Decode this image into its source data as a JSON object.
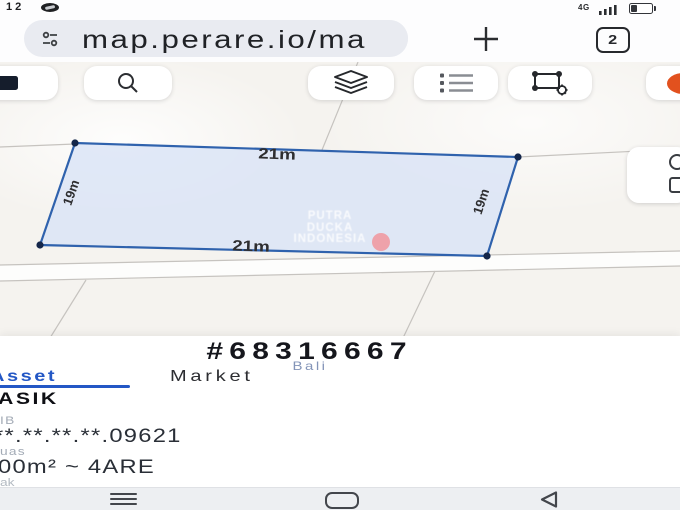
{
  "status_bar": {
    "time": "12",
    "network": "4G"
  },
  "browser": {
    "url": "map.perare.io/ma",
    "tab_count": "2"
  },
  "map": {
    "dimensions": {
      "top": "21m",
      "bottom": "21m",
      "left": "19m",
      "right": "19m"
    },
    "watermark_lines": [
      "PUTRA",
      "DUCKA",
      "INDONESIA"
    ],
    "colors": {
      "parcel_fill": "#d9e4f6",
      "parcel_border": "#2f62ad",
      "vertex": "#14264a",
      "watermark_dot": "#ef9aa2",
      "record_button": "#e2511e"
    }
  },
  "sheet": {
    "parcel_id": "#68316667",
    "region": "Bali",
    "tabs": [
      {
        "label": "Asset",
        "active": true
      },
      {
        "label": "Market",
        "active": false
      }
    ],
    "title": "ASIK",
    "fields": [
      {
        "label": "IB",
        "value": "**.**.**.**.09621"
      },
      {
        "label": "uas",
        "value": "00m² ~ 4ARE"
      }
    ],
    "partial_text": "ak",
    "accent": "#2357c5"
  },
  "icons": [
    "eye-icon",
    "signal-icon",
    "battery-icon",
    "tune-icon",
    "new-tab-icon",
    "tab-switcher",
    "map-style-icon",
    "search-icon",
    "layers-icon",
    "legend-icon",
    "polygon-settings-icon",
    "record-icon",
    "locate-icon",
    "capture-icon",
    "menu-icon",
    "home-icon",
    "back-icon"
  ]
}
